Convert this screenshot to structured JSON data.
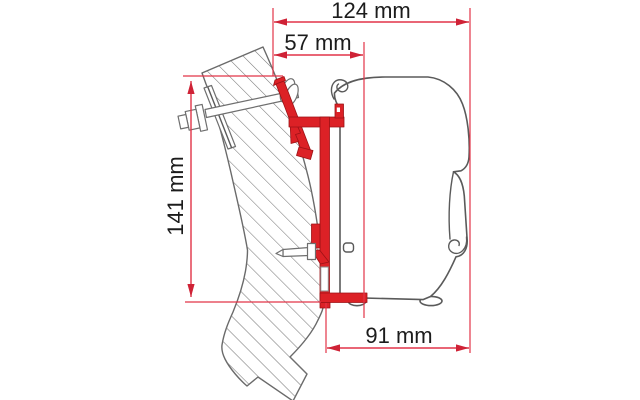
{
  "diagram": {
    "type": "technical-dimension-drawing",
    "subject": "awning adapter bracket mounted between vehicle wall and awning case, side profile",
    "dimensions": [
      {
        "id": "total-depth",
        "label": "124 mm",
        "value": 124,
        "unit": "mm",
        "orientation": "horizontal"
      },
      {
        "id": "bracket-depth",
        "label": "57 mm",
        "value": 57,
        "unit": "mm",
        "orientation": "horizontal"
      },
      {
        "id": "bracket-height",
        "label": "141 mm",
        "value": 141,
        "unit": "mm",
        "orientation": "vertical"
      },
      {
        "id": "case-depth",
        "label": "91 mm",
        "value": 91,
        "unit": "mm",
        "orientation": "horizontal"
      }
    ],
    "parts": [
      {
        "id": "wall",
        "name": "vehicle-wall-cross-section",
        "style": "diagonal-hatched"
      },
      {
        "id": "adapter",
        "name": "adapter-bracket-profile",
        "color": "#dc2126"
      },
      {
        "id": "awning",
        "name": "awning-case-outline",
        "color": "#5a5a5a"
      },
      {
        "id": "bolt-upper",
        "name": "upper-mounting-bolt"
      },
      {
        "id": "bolt-lower",
        "name": "lower-fixing-screw"
      }
    ],
    "colors": {
      "dimension_lines": "#e23448",
      "arrowheads": "#cf2236",
      "bracket_red": "#dc2126",
      "outline_gray": "#5a5a5a",
      "hatch_gray": "#7a7a7a",
      "text": "#1c1c1c",
      "background": "#ffffff"
    }
  }
}
